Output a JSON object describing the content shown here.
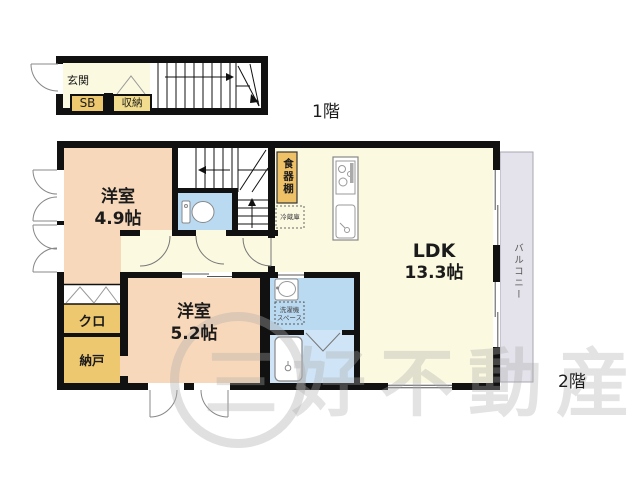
{
  "floor1": {
    "label": "1階",
    "genkan": "玄関",
    "shoe_box": "SB",
    "storage": "収納"
  },
  "floor2": {
    "label": "2階",
    "room1_name": "洋室",
    "room1_size": "4.9帖",
    "room2_name": "洋室",
    "room2_size": "5.2帖",
    "ldk_name": "LDK",
    "ldk_size": "13.3帖",
    "closet": "クロ",
    "nando": "納戸",
    "cupboard": "食器棚",
    "refrigerator": "冷蔵庫",
    "washer_line1": "洗濯機",
    "washer_line2": "スペース",
    "balcony": "バルコニー"
  },
  "watermark": "三好不動産",
  "colors": {
    "wall": "#111111",
    "floor_cream": "#fbf9e0",
    "room_peach": "#f8d8ba",
    "accent_gold": "#eec86f",
    "storage_gold": "#f2dd8e",
    "water_blue": "#badaf2",
    "bath_blue": "#cfe4f6",
    "balcony_gray": "#e4e2ea",
    "symbol_gray": "#888888"
  }
}
